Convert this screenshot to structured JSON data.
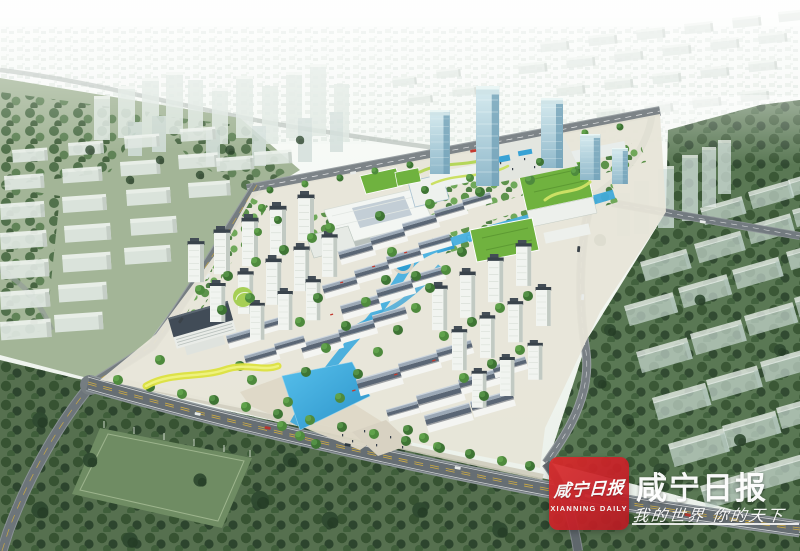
{
  "watermark": {
    "logo_calligraphy": "咸宁日报",
    "logo_subtitle": "XIANNING DAILY",
    "brand_name": "咸宁日报",
    "slogan": "我的世界 你的天下",
    "brand_red": "#c82128",
    "text_color": "#ffffff"
  },
  "palette": {
    "sky_haze": "#f6faf6",
    "distant_city": "#d9e3db",
    "field_green": "#a3b597",
    "forest_green": "#4e6e48",
    "dark_forest": "#2f462e",
    "ghost_building": "#dde5df",
    "road_asphalt": "#71797e",
    "lane_yellow": "#d8b13c",
    "site_paving": "#e7e5d8",
    "canal_blue": "#35a3d8",
    "roof_slate": "#5a6675",
    "tower_wall": "#f1f4f0",
    "tower_cap": "#39434b",
    "glass_blue": "#9dc3d4",
    "green_roof": "#70b23f",
    "tree_green": "#4e8a3d",
    "accent_yellow": "#dce23f"
  }
}
